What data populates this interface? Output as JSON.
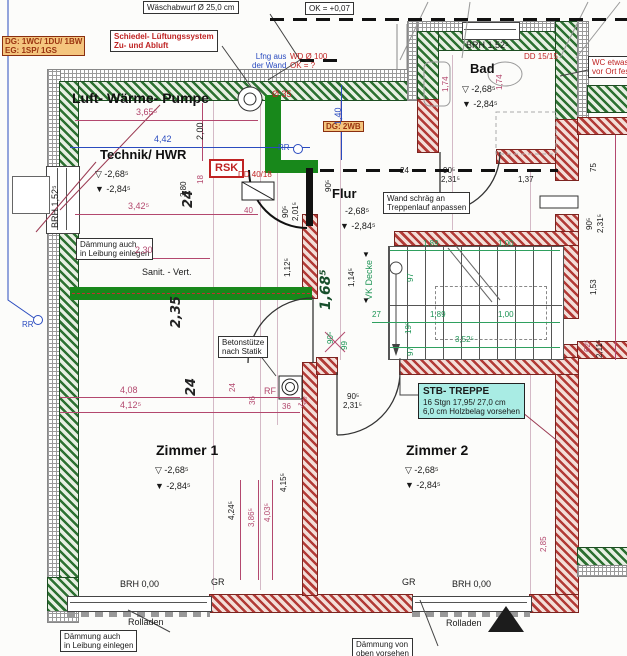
{
  "meta": {
    "type": "architectural floor plan (basement/DG)",
    "language": "de"
  },
  "colors": {
    "wall_existing_green": "#2c7031",
    "wall_new_red": "#b23a36",
    "highlight_green": "#18881b",
    "dim_pink": "#b3486e",
    "dim_blue": "#2a4bbf",
    "dim_green": "#1d9455",
    "note_red": "#bf2323",
    "label_orange_bg": "#f4c57e",
    "label_cyan_bg": "#a9ece4"
  },
  "rooms": {
    "lwp": {
      "name": "Luft- Wärme- Pumpe"
    },
    "technik": {
      "name": "Technik/ HWR",
      "lvl1": "▽ -2,68⁵",
      "lvl2": "▼ -2,84⁵"
    },
    "bad": {
      "name": "Bad",
      "lvl1": "▽ -2,68⁵",
      "lvl2": "▼ -2,84⁵"
    },
    "flur": {
      "name": "Flur",
      "lvl1": "-2,68⁵",
      "lvl2": "▼ -2,84⁵"
    },
    "z1": {
      "name": "Zimmer 1",
      "lvl1": "▽ -2,68⁵",
      "lvl2": "▼ -2,84⁵"
    },
    "z2": {
      "name": "Zimmer 2",
      "lvl1": "▽ -2,68⁵",
      "lvl2": "▼ -2,84⁵"
    }
  },
  "callouts": {
    "waesch": "Wäschabwurf Ø 25,0 cm",
    "ok": "OK = +0,07",
    "schiedel1": "Schiedel- Lüftungssystem",
    "schiedel2": "Zu- und Abluft",
    "units1": "DG: 1WC/ 1DU/ 1BW",
    "units2": "EG: 1SP/ 1GS",
    "dg2wb": "DG: 2WB",
    "lfng1": "Lfng aus",
    "lfng2": "der Wand",
    "wd1": "WD Ø 100",
    "wd2": "OK = ?",
    "d35": "Ø 35",
    "dd1515": "DD 15/15",
    "dd4018": "DD 40/18",
    "rsk": "RSK",
    "wc1": "WC etwas",
    "wc2": "vor Ort fes",
    "daemm1a": "Dämmung auch",
    "daemm1b": "in Leibung einlegen",
    "sanit": "Sanit. - Vert.",
    "wand1": "Wand schräg an",
    "wand2": "Treppenlauf anpassen",
    "beton1": "Betonstütze",
    "beton2": "nach Statik",
    "tr1": "STB- TREPPE",
    "tr2": "16 Stgn 17,95/ 27,0 cm",
    "tr3": "6,0 cm Holzbelag vorsehen",
    "daemm2a": "Dämmung auch",
    "daemm2b": "in Leibung einlegen",
    "daemm3a": "Dämmung von",
    "daemm3b": "oben vorsehen",
    "roll1": "Rolladen",
    "roll2": "Rolladen",
    "brh_top": "BRH 1,52⁵",
    "brh_left": "BRH 1,52⁵",
    "brh0a": "BRH 0,00",
    "brh0b": "BRH 0,00",
    "gr1": "GR",
    "gr2": "GR",
    "rr1": "RR",
    "rr2": "RR",
    "rf": "RF",
    "vk": "VK Decke"
  },
  "dims": {
    "d365": "3,65⁵",
    "d200": "2,00",
    "d442": "4,42",
    "d140": "1,40",
    "d174a": "1,74",
    "d174b": "1,74",
    "d342": "3,42⁵",
    "d380": "3,80",
    "d18": "18",
    "d24a": "24",
    "d230": "2,30",
    "d40": "40",
    "d90a": "90⁵",
    "d201": "2,01⁵",
    "d90b": "90⁵",
    "d112": "1,12⁵",
    "d114": "1,14⁵",
    "d168": "1,68⁵",
    "d24d": "24",
    "d90c": "90⁵",
    "d231a": "2,31⁵",
    "d137": "1,37",
    "d235": "2,35",
    "d189a": "1,89",
    "d100a": "1,00",
    "d97a": "97",
    "d27": "27",
    "d19": "19⁵",
    "d189b": "1,89",
    "d100b": "1,00",
    "d352": "3,52⁵",
    "d97b": "97",
    "d99": "99",
    "d90d": "90⁵",
    "d75": "75",
    "d90e": "90⁵",
    "d231b": "2,31⁵",
    "d153": "1,53",
    "d62": "62⁵",
    "d211": "2,11⁵",
    "d24b": "24",
    "d24c": "24",
    "d36a": "36",
    "d36b": "36",
    "d12": "12⁵",
    "d408": "4,08",
    "d412": "4,12⁵",
    "d90f": "90⁵",
    "d231c": "2,31⁵",
    "d415": "4,15⁵",
    "d424": "4,24⁵",
    "d386": "3,86⁵",
    "d403": "4,03⁵",
    "d285": "2,85"
  }
}
